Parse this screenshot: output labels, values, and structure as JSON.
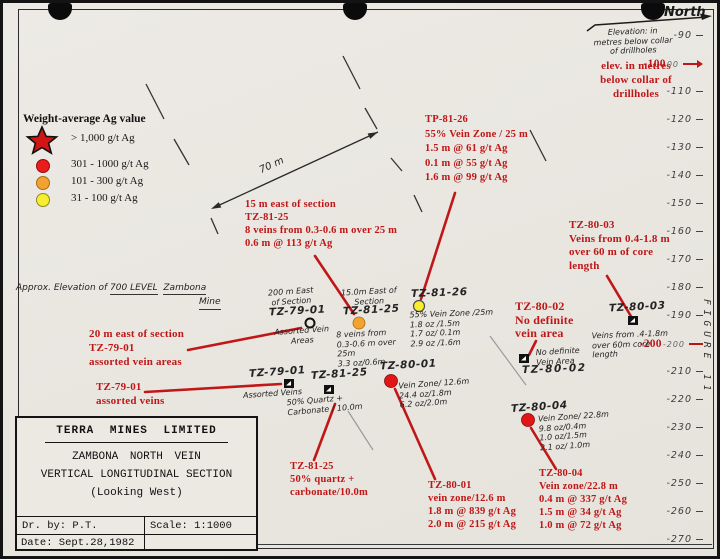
{
  "figure_label": "FIGURE 11",
  "legend": {
    "title": "Weight-average Ag value",
    "items": [
      {
        "symbol": "star-icon",
        "color": "#d31414",
        "label": "> 1,000 g/t Ag"
      },
      {
        "symbol": "circle-icon",
        "color": "#ea1c1c",
        "label": "301 - 1000 g/t Ag"
      },
      {
        "symbol": "circle-icon",
        "color": "#f1a231",
        "label": "101 - 300 g/t Ag"
      },
      {
        "symbol": "circle-icon",
        "color": "#f6ee2f",
        "label": "31 - 100 g/t Ag"
      }
    ]
  },
  "elevation_scale": {
    "ticks": [
      {
        "label": "-90"
      },
      {
        "label": "-100",
        "red": true,
        "hw": "00"
      },
      {
        "label": "-110"
      },
      {
        "label": "-120"
      },
      {
        "label": "-130"
      },
      {
        "label": "-140"
      },
      {
        "label": "-150"
      },
      {
        "label": "-160"
      },
      {
        "label": "-170"
      },
      {
        "label": "-180"
      },
      {
        "label": "-190"
      },
      {
        "label": "-200",
        "red": true,
        "hw": "-200"
      },
      {
        "label": "-210"
      },
      {
        "label": "-220"
      },
      {
        "label": "-230"
      },
      {
        "label": "-240"
      },
      {
        "label": "-250"
      },
      {
        "label": "-260"
      },
      {
        "label": "-270"
      }
    ]
  },
  "red_notes": {
    "elev_note": [
      "elev. in metres",
      "below collar of",
      "drillholes"
    ],
    "tz8125_east": [
      "15 m east of section",
      "TZ-81-25",
      "8 veins from 0.3-0.6 m over 25 m",
      "0.6 m @ 113 g/t Ag"
    ],
    "tp8126": [
      "TP-81-26",
      "55% Vein Zone / 25 m",
      "1.5 m @ 61 g/t Ag",
      "0.1 m @ 55 g/t Ag",
      "1.6 m @ 99 g/t Ag"
    ],
    "tz8003": [
      "TZ-80-03",
      "Veins from 0.4-1.8 m",
      "over 60 m of core",
      "length"
    ],
    "tz8002": [
      "TZ-80-02",
      "No definite",
      "vein area"
    ],
    "tz7901_east": [
      "20 m east of section",
      "TZ-79-01",
      "assorted vein areas"
    ],
    "tz7901": [
      "TZ-79-01",
      "assorted veins"
    ],
    "tz8125": [
      "TZ-81-25",
      "50% quartz +",
      "carbonate/10.0m"
    ],
    "tz8001": [
      "TZ-80-01",
      "vein zone/12.6 m",
      "1.8 m @ 839 g/t Ag",
      "2.0 m @ 215 g/t Ag"
    ],
    "tz8004": [
      "TZ-80-04",
      "Vein zone/22.8 m",
      "0.4 m @ 337 g/t Ag",
      "1.5 m @ 34 g/t Ag",
      "1.0 m @ 72 g/t Ag"
    ]
  },
  "hw_notes": {
    "north": "North",
    "elev": [
      "Elevation: in",
      "metres below collar",
      "of drillholes"
    ],
    "level_p1": "Approx. Elevation of ",
    "level_p2": "700 LEVEL",
    "level_p3": "Zambona",
    "level_p4": "Mine",
    "dim70": "70 m",
    "h7901e_top": [
      "200 m East",
      "of Section"
    ],
    "h7901e_hole": "TZ-79-01",
    "h7901e_sub": [
      "Assorted Vein",
      "Areas"
    ],
    "h8125e_top": [
      "15.0m East of",
      "Section"
    ],
    "h8125e_hole": "TZ-81-25",
    "h8125e_sub": [
      "8 veins from",
      "0.3-0.6 m over",
      "25m",
      "3.3 oz/0.6m"
    ],
    "h8126_hole": "TZ-81-26",
    "h8126_sub": [
      "55% Vein Zone /25m",
      "1.8 oz /1.5m",
      "1.7 oz/ 0.1m",
      "2.9 oz /1.6m"
    ],
    "h7901_hole": "TZ-79-01",
    "h7901_sub": [
      "Assorted Veins"
    ],
    "h8125_hole": "TZ-81-25",
    "h8125_sub": [
      "50% Quartz +",
      "Carbonate / 10.0m"
    ],
    "h8001_hole": "TZ-80-01",
    "h8001_sub": [
      "Vein Zone/ 12.6m",
      "24.4 oz/1.8m",
      "6.2 oz/2.0m"
    ],
    "h8002_pre": [
      "No definite",
      "Vein Area"
    ],
    "h8002_hole": "TZ-80-02",
    "h8003_hole": "TZ-80-03",
    "h8003_sub": [
      "Veins from .4-1.8m",
      "over 60m core",
      "length"
    ],
    "h8004_hole": "TZ-80-04",
    "h8004_sub": [
      "Vein Zone/ 22.8m",
      "9.8 oz/0.4m",
      "1.0 oz/1.5m",
      "2.1 oz/ 1.0m"
    ]
  },
  "markers": {
    "tz7901_east": "open-circle",
    "tz8125_east": "orange-circle",
    "tz8126": "yellow-circle",
    "tz7901": "black-flag",
    "tz8125": "black-flag",
    "tz8001": "red-circle",
    "tz8002": "black-flag",
    "tz8003": "black-flag",
    "tz8004": "red-circle"
  },
  "title_block": {
    "company": "TERRA MINES LIMITED",
    "line1": "ZAMBONA NORTH VEIN",
    "line2": "VERTICAL LONGITUDINAL SECTION",
    "line3": "(Looking West)",
    "drawn_by": "Dr. by: P.T.",
    "scale": "Scale: 1:1000",
    "date": "Date: Sept.28,1982"
  }
}
